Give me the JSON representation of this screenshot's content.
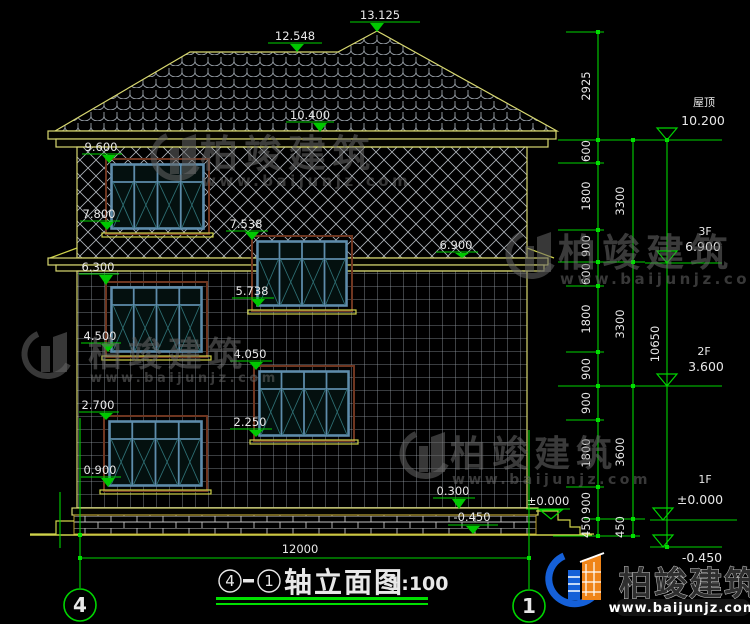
{
  "drawing": {
    "building_markers": [
      "13.125",
      "12.548",
      "10.400",
      "9.600",
      "7.800",
      "7.538",
      "6.900",
      "6.300",
      "5.738",
      "4.500",
      "4.050",
      "2.700",
      "2.250",
      "0.900",
      "0.300",
      "±0.000",
      "-0.450"
    ],
    "chain_inner": [
      "2925",
      "600",
      "1800",
      "900",
      "600",
      "1800",
      "900",
      "900",
      "1800",
      "900",
      "450"
    ],
    "chain_middle": [
      "3300",
      "3300",
      "3600",
      "450"
    ],
    "chain_overall": "10650",
    "levels_right": [
      {
        "label": "屋顶",
        "value": "10.200"
      },
      {
        "label": "3F",
        "value": "6.900"
      },
      {
        "label": "2F",
        "value": "3.600"
      },
      {
        "label": "1F",
        "value": "±0.000"
      },
      {
        "label": "",
        "value": "-0.450"
      }
    ],
    "overall_width": "12000",
    "grid_left": "4",
    "grid_right": "1"
  },
  "title_block": {
    "axis_start": "4",
    "axis_end": "1",
    "label": "轴立面图",
    "scale": "1:100"
  },
  "watermark": {
    "brand": "柏竣建筑",
    "url": "www.baijunjz.com"
  },
  "logo": {
    "brand": "柏竣建筑",
    "url": "www.baijunjz.com"
  },
  "colors": {
    "marker_green": "#00d400",
    "line_yellow": "#cfd34a",
    "window_frame": "#5e8cab",
    "window_trim": "#6f3620",
    "logo_blue": "#1560d8",
    "logo_orange": "#ef8418"
  }
}
